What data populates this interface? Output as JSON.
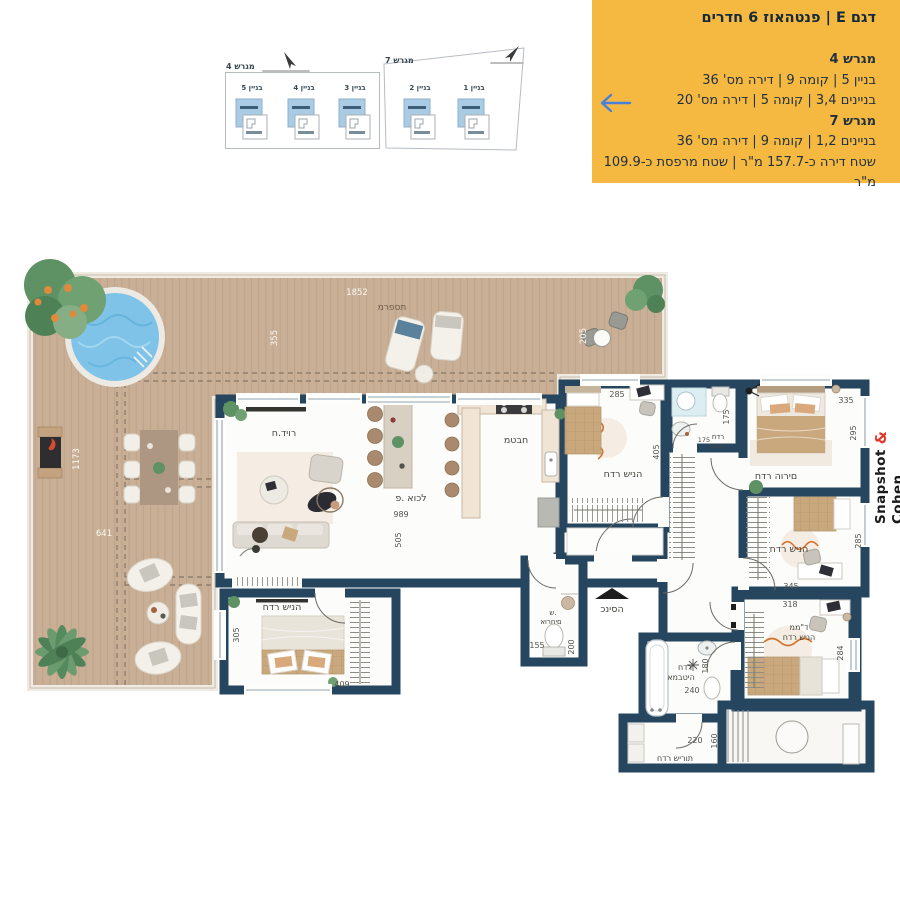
{
  "info_box": {
    "title": "דגם E | פנטהאוז 6 חדרים",
    "lot4_header": "מגרש 4",
    "lot4_line1": "בניין 5 | קומה 9 | דירה מס' 36",
    "lot4_line2": "בניינים 3,4 | קומה 5 | דירה מס' 20",
    "lot7_header": "מגרש 7",
    "lot7_line1": "בניינים 1,2 | קומה 9 | דירה מס' 36",
    "area_line": "שטח דירה כ-157.7 מ\"ר | שטח מרפסת כ-109.9 מ\"ר",
    "bg_color": "#F5B942",
    "arrow_color": "#4A7FD9"
  },
  "site_plan": {
    "lot4": {
      "label": "מגרש 4",
      "buildings": [
        "בניין 5",
        "בניין 4",
        "בניין 3"
      ]
    },
    "lot7": {
      "label": "מגרש 7",
      "buildings": [
        "בניין 2",
        "בניין 1"
      ]
    },
    "highlight_color": "#A9CBE4"
  },
  "brand": {
    "left": "Snapshot",
    "amp": "&",
    "right": "Cohen",
    "amp_color": "#E2362B"
  },
  "rooms": {
    "terrace": {
      "label": "מרפסת",
      "dim_top": "1852",
      "dim_upper": "355",
      "dim_right": "205",
      "dim_left": "1173",
      "dim_lower": "641"
    },
    "living": {
      "label": "ח.דיור"
    },
    "dining": {
      "label": "פ. אוכל",
      "dim_w": "989",
      "dim_h": "505"
    },
    "kitchen": {
      "label": "מטבח"
    },
    "bedroom_top": {
      "label": "חדר שינה",
      "dim_w": "285",
      "dim_h": "405"
    },
    "washroom": {
      "line1": "חדר",
      "line2": "רחצה",
      "dim_w": "175",
      "dim_h": "175"
    },
    "parents": {
      "label": "חדר הורים",
      "dim_w": "335",
      "dim_h": "295"
    },
    "bedroom_right": {
      "label": "חדר שינה",
      "dim_w": "345",
      "dim_h": "285"
    },
    "mamad": {
      "line1": "ממ\"ד",
      "line2": "חדר שינה",
      "dim_w": "318",
      "dim_h": "284"
    },
    "bedroom_bl": {
      "label": "חדר שינה",
      "dim_w": "409",
      "dim_h": "305"
    },
    "entrance": {
      "label": "כניסה"
    },
    "guest_wc": {
      "line1": "ש.",
      "line2": "אורחים",
      "dim_w": "155",
      "dim_h": "200"
    },
    "bathroom": {
      "line1": "חדר",
      "line2": "אמבטיה",
      "dim_w": "240",
      "dim_h": "180"
    },
    "service": {
      "label": "חדר שירות",
      "dim_w": "220",
      "dim_h": "160"
    }
  }
}
